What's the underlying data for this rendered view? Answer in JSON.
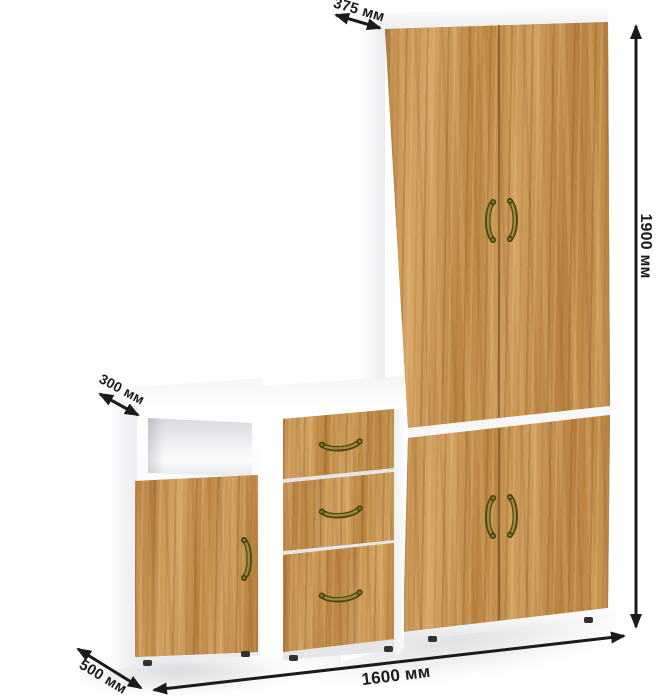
{
  "annotations": {
    "depth_wardrobe": "375 мм",
    "total_height": "1900 мм",
    "upper_depth_left_unit": "300 мм",
    "lower_depth_left_unit": "500 мм",
    "total_width": "1600 мм"
  },
  "palette": {
    "wood": "#c6914f",
    "carcass_white": "#ffffff",
    "handle_brass": "#8d813a",
    "dimension_ink": "#1b1b1d"
  }
}
